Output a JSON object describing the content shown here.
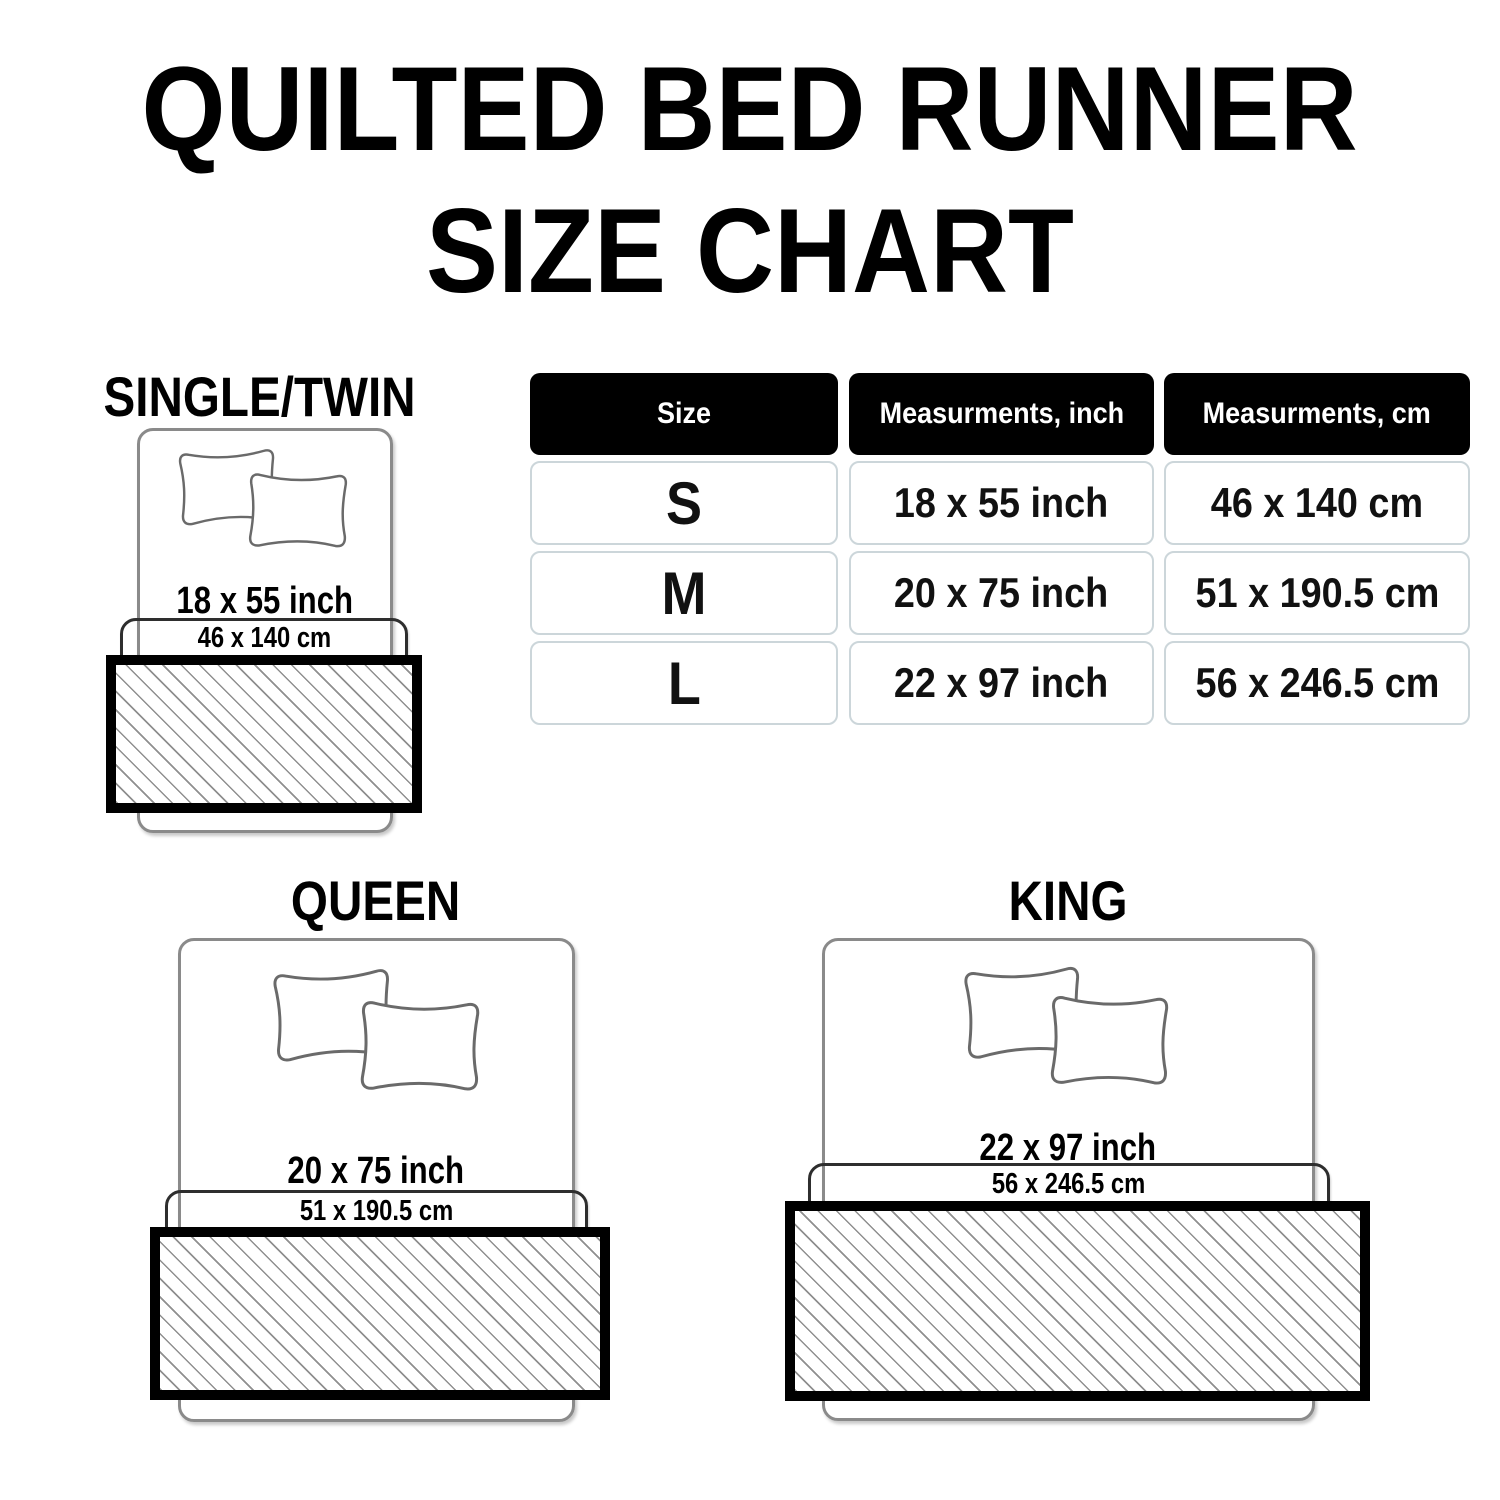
{
  "title": {
    "line1": "QUILTED BED RUNNER",
    "line2": "SIZE CHART"
  },
  "table": {
    "headers": {
      "size": "Size",
      "inch": "Measurments, inch",
      "cm": "Measurments, cm"
    },
    "rows": [
      {
        "size": "S",
        "inch": "18 x 55 inch",
        "cm": "46 x 140 cm"
      },
      {
        "size": "M",
        "inch": "20 x 75 inch",
        "cm": "51 x 190.5 cm"
      },
      {
        "size": "L",
        "inch": "22 x 97 inch",
        "cm": "56 x 246.5 cm"
      }
    ]
  },
  "diagrams": [
    {
      "label": "SINGLE/TWIN",
      "inch": "18 x 55 inch",
      "cm": "46 x 140 cm"
    },
    {
      "label": "QUEEN",
      "inch": "20 x 75 inch",
      "cm": "51 x 190.5 cm"
    },
    {
      "label": "KING",
      "inch": "22 x 97 inch",
      "cm": "56 x 246.5 cm"
    }
  ],
  "chart_data": {
    "type": "table",
    "columns": [
      "Size",
      "Measurments, inch",
      "Measurments, cm"
    ],
    "rows": [
      [
        "S",
        "18 x 55 inch",
        "46 x 140 cm"
      ],
      [
        "M",
        "20 x 75 inch",
        "51 x 190.5 cm"
      ],
      [
        "L",
        "22 x 97 inch",
        "56 x 246.5 cm"
      ]
    ]
  },
  "colors": {
    "text_black": "#000000",
    "header_bg": "#000000",
    "header_text": "#ffffff",
    "table_cell_border": "#ccd6da",
    "bed_outline_gray": "#8a8a8a",
    "pillow_outline_gray": "#6a6a6a",
    "hatch_line_gray": "#8f8f8f",
    "runner_border": "#000000"
  }
}
